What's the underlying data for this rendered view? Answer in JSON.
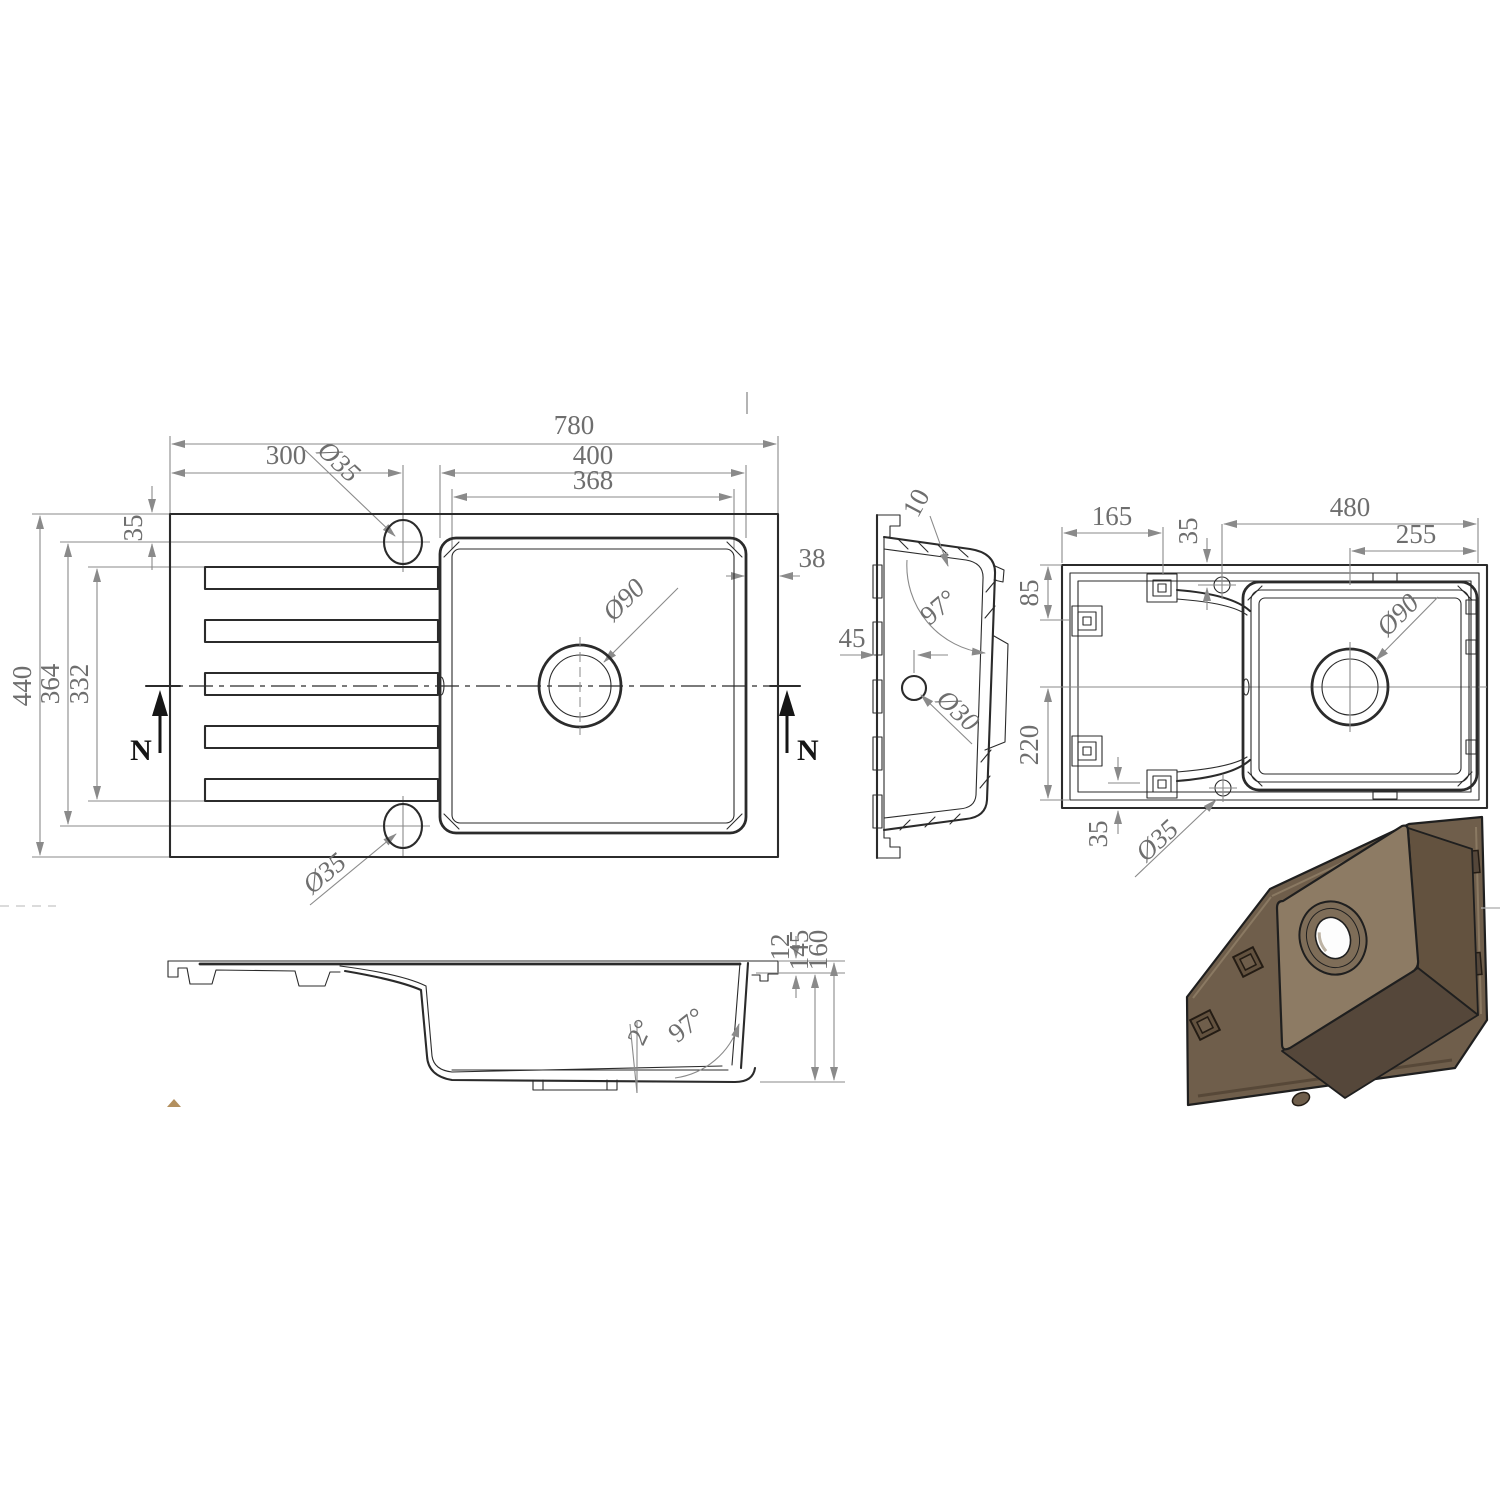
{
  "drawing": {
    "title": "Kitchen sink with drainer - dimensioned CAD drawing",
    "plan": {
      "overall_width": "780",
      "left_width": "300",
      "bowl_width": "400",
      "bowl_inner_width": "368",
      "hole_inset": "35",
      "overall_depth": "440",
      "holes_span": "364",
      "drainer_span": "332",
      "rim": "38",
      "tap_hole_top": "Ø35",
      "tap_hole_bottom": "Ø35",
      "drain": "Ø90",
      "section_left": "N",
      "section_right": "N"
    },
    "side_section": {
      "wall_thickness": "10",
      "bowl_angle": "97°",
      "hole_offset": "45",
      "overflow_hole": "Ø30"
    },
    "bottom_view": {
      "pad_offset": "165",
      "hole_inset": "35",
      "overall_width": "480",
      "drain_offset": "255",
      "pad_top": "85",
      "pad_span": "220",
      "pad_bottom": "35",
      "tap_hole": "Ø35",
      "drain": "Ø90"
    },
    "front_section": {
      "rim_thickness": "12",
      "bowl_depth": "145",
      "overall_height": "160",
      "base_angle": "2°",
      "wall_angle": "97°"
    },
    "colors": {
      "iso_panel": "#6f5e4b",
      "iso_top": "#8d7b64",
      "iso_side": "#63523f",
      "iso_bottom": "#55473a",
      "iso_ring": "#7e6d58",
      "iso_hole": "#fdfdfd",
      "artifact_tan": "#b3905f"
    }
  }
}
